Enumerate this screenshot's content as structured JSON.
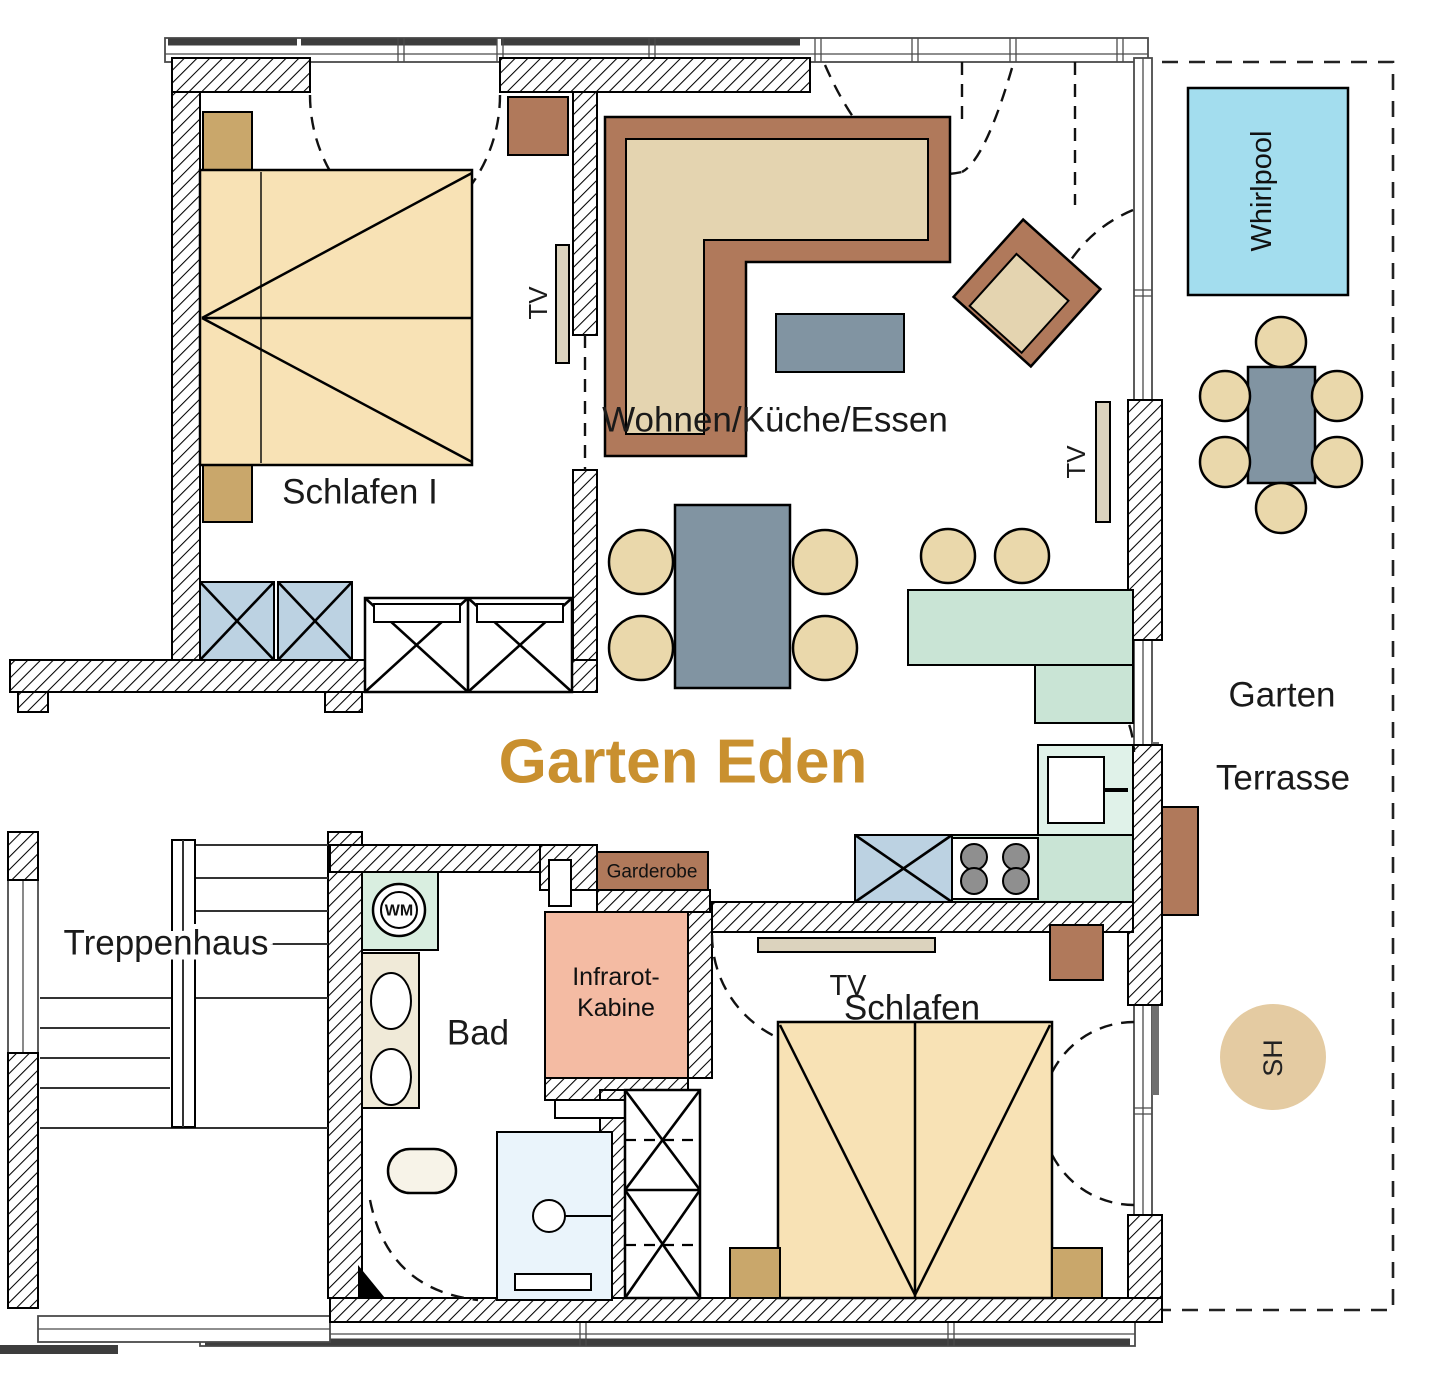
{
  "title": {
    "text": "Garten Eden"
  },
  "rooms": {
    "schlafen1": "Schlafen I",
    "wohnen": "Wohnen/Küche/Essen",
    "bad": "Bad",
    "treppenhaus": "Treppenhaus",
    "schlafen2": "Schlafen",
    "garten": "Garten",
    "terrasse": "Terrasse"
  },
  "features": {
    "whirlpool": "Whirlpool",
    "infrarot_line1": "Infrarot-",
    "infrarot_line2": "Kabine",
    "garderobe": "Garderobe",
    "wm": "WM",
    "sh": "SH",
    "tv": "TV"
  },
  "colors": {
    "title": "#C9902F",
    "bed": "#F8E2B5",
    "nightstand": "#C9A76B",
    "sofa_frame": "#B0795B",
    "sofa_cushion": "#E4D4B0",
    "table_gray": "#8194A2",
    "chair": "#EAD8AB",
    "kitchen": "#C9E4D5",
    "kitchen_light": "#E0F2E9",
    "burner": "#8F8F8F",
    "wardrobe_blue": "#BCD2E2",
    "shower": "#EAF4FB",
    "infrared": "#F4BBA3",
    "wm_box": "#D9EEE0",
    "whirlpool": "#A3DDEE",
    "brown": "#B0795B",
    "sh_circle": "#E4CBA2",
    "tv_bar": "#DCD3BE"
  }
}
